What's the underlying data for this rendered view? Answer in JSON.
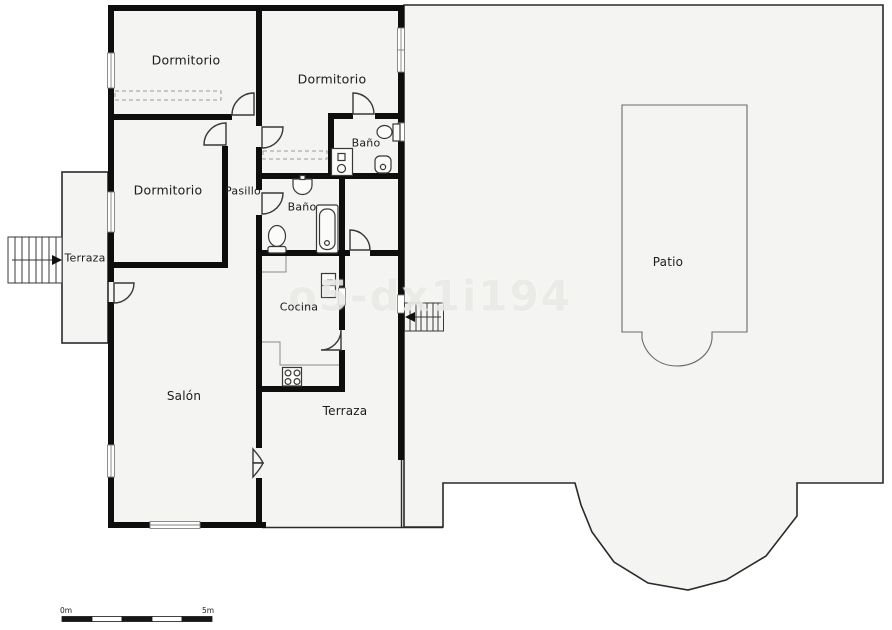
{
  "plan": {
    "title_watermark": "o5-dx1i194",
    "rooms": [
      {
        "id": "dormitorio-top-left",
        "label": "Dormitorio"
      },
      {
        "id": "dormitorio-top-mid",
        "label": "Dormitorio"
      },
      {
        "id": "dormitorio-left",
        "label": "Dormitorio"
      },
      {
        "id": "bano-top",
        "label": "Baño"
      },
      {
        "id": "bano-mid",
        "label": "Baño"
      },
      {
        "id": "pasillo",
        "label": "Pasillo"
      },
      {
        "id": "cocina",
        "label": "Cocina"
      },
      {
        "id": "salon",
        "label": "Salón"
      },
      {
        "id": "terraza-left",
        "label": "Terraza"
      },
      {
        "id": "terraza-bottom",
        "label": "Terraza"
      },
      {
        "id": "patio",
        "label": "Patio"
      }
    ],
    "scale_bar": {
      "min": "0m",
      "max": "5m"
    },
    "fixtures": [
      "toilet",
      "bidet",
      "shower-tray",
      "washbasin",
      "bathtub",
      "toilet",
      "fridge",
      "stove",
      "stairs",
      "stairs"
    ],
    "colors": {
      "wall": "#0e0e0e",
      "thin_line": "#2a2a2a",
      "room_fill": "#f4f4f2",
      "fixture_stroke": "#383838"
    }
  }
}
